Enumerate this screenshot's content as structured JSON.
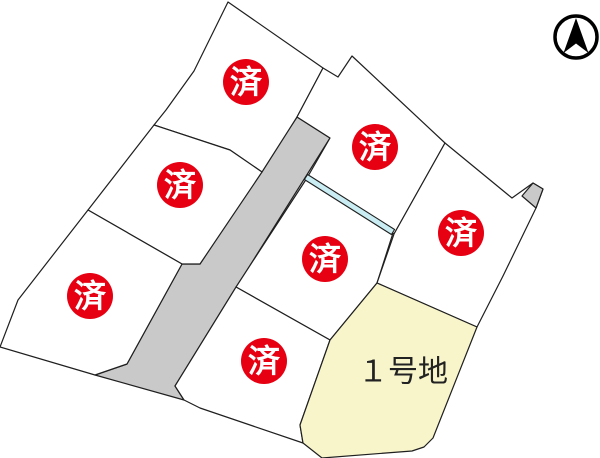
{
  "canvas": {
    "width": 600,
    "height": 458,
    "background": "#ffffff"
  },
  "colors": {
    "outline": "#1f1f1f",
    "parcel_fill": "#ffffff",
    "road_fill": "#c9c9c9",
    "stream_fill": "#c9edf2",
    "sold_red": "#e60012",
    "sold_text_color": "#ffffff",
    "lot1_fill": "#f8f5cb",
    "lot1_text_color": "#222222",
    "compass_color": "#000000"
  },
  "labels": {
    "sold_stamp": "済",
    "lot1": "１号地"
  },
  "parcels": [
    {
      "name": "road-main",
      "fill": "road_fill",
      "interactable": false,
      "points": [
        [
          297,
          117
        ],
        [
          330,
          138
        ],
        [
          222,
          310
        ],
        [
          175,
          386
        ],
        [
          184,
          400
        ],
        [
          95,
          375
        ],
        [
          127,
          364
        ],
        [
          182,
          264
        ],
        [
          200,
          264
        ]
      ]
    },
    {
      "name": "parcel-top-left",
      "fill": "parcel_fill",
      "interactable": false,
      "points": [
        [
          228,
          2
        ],
        [
          323,
          68
        ],
        [
          297,
          117
        ],
        [
          262,
          172
        ],
        [
          230,
          150
        ],
        [
          154,
          125
        ],
        [
          166,
          110
        ],
        [
          194,
          71
        ]
      ]
    },
    {
      "name": "parcel-mid-left",
      "fill": "parcel_fill",
      "interactable": false,
      "points": [
        [
          154,
          125
        ],
        [
          230,
          150
        ],
        [
          262,
          172
        ],
        [
          200,
          264
        ],
        [
          182,
          264
        ],
        [
          88,
          210
        ]
      ]
    },
    {
      "name": "parcel-bottom-left",
      "fill": "parcel_fill",
      "interactable": false,
      "points": [
        [
          88,
          210
        ],
        [
          182,
          264
        ],
        [
          127,
          364
        ],
        [
          95,
          375
        ],
        [
          0,
          347
        ],
        [
          18,
          300
        ]
      ]
    },
    {
      "name": "parcel-top-right",
      "fill": "parcel_fill",
      "interactable": false,
      "points": [
        [
          323,
          68
        ],
        [
          338,
          77
        ],
        [
          352,
          56
        ],
        [
          445,
          143
        ],
        [
          394,
          234
        ],
        [
          307,
          178
        ],
        [
          330,
          138
        ],
        [
          297,
          117
        ]
      ]
    },
    {
      "name": "parcel-center",
      "fill": "parcel_fill",
      "interactable": false,
      "points": [
        [
          307,
          178
        ],
        [
          393,
          233
        ],
        [
          377,
          283
        ],
        [
          330,
          340
        ],
        [
          236,
          287
        ]
      ]
    },
    {
      "name": "parcel-right",
      "fill": "parcel_fill",
      "interactable": false,
      "points": [
        [
          445,
          143
        ],
        [
          512,
          198
        ],
        [
          533,
          183
        ],
        [
          543,
          189
        ],
        [
          536,
          208
        ],
        [
          503,
          276
        ],
        [
          477,
          327
        ],
        [
          377,
          283
        ],
        [
          394,
          234
        ]
      ]
    },
    {
      "name": "parcel-bottom-center",
      "fill": "parcel_fill",
      "interactable": false,
      "points": [
        [
          236,
          287
        ],
        [
          330,
          340
        ],
        [
          300,
          425
        ],
        [
          303,
          443
        ],
        [
          200,
          408
        ],
        [
          184,
          400
        ],
        [
          175,
          386
        ]
      ]
    },
    {
      "name": "parcel-lot-1",
      "fill": "lot1_fill",
      "interactable": true,
      "points": [
        [
          377,
          283
        ],
        [
          477,
          327
        ],
        [
          433,
          438
        ],
        [
          424,
          447
        ],
        [
          412,
          451
        ],
        [
          322,
          458
        ],
        [
          303,
          443
        ],
        [
          300,
          425
        ],
        [
          330,
          340
        ]
      ]
    },
    {
      "name": "road-sliver",
      "fill": "road_fill",
      "interactable": false,
      "points": [
        [
          522,
          196
        ],
        [
          533,
          183
        ],
        [
          543,
          189
        ],
        [
          536,
          208
        ]
      ]
    }
  ],
  "stream": {
    "name": "stream-channel",
    "points": [
      [
        304.4,
        179.5
      ],
      [
        391.4,
        234.5
      ],
      [
        394.6,
        229.5
      ],
      [
        307.6,
        174.5
      ]
    ]
  },
  "sold_markers": [
    {
      "name": "sold-stamp-top-left",
      "x": 246,
      "y": 82
    },
    {
      "name": "sold-stamp-mid-left",
      "x": 180,
      "y": 185
    },
    {
      "name": "sold-stamp-bottom-left",
      "x": 90,
      "y": 296
    },
    {
      "name": "sold-stamp-top-right",
      "x": 375,
      "y": 147
    },
    {
      "name": "sold-stamp-center",
      "x": 325,
      "y": 259
    },
    {
      "name": "sold-stamp-right",
      "x": 461,
      "y": 233
    },
    {
      "name": "sold-stamp-bottom-center",
      "x": 264,
      "y": 361
    }
  ],
  "sold_marker_style": {
    "radius": 23,
    "font_size": 32
  },
  "lot1_label": {
    "x": 403,
    "y": 372,
    "font_size": 30
  },
  "compass": {
    "cx": 576,
    "cy": 37,
    "radius": 21,
    "ring_width": 3.5,
    "arrow_path": "M576 18 L588.5 53 L576 43.5 L563.5 53 Z"
  }
}
